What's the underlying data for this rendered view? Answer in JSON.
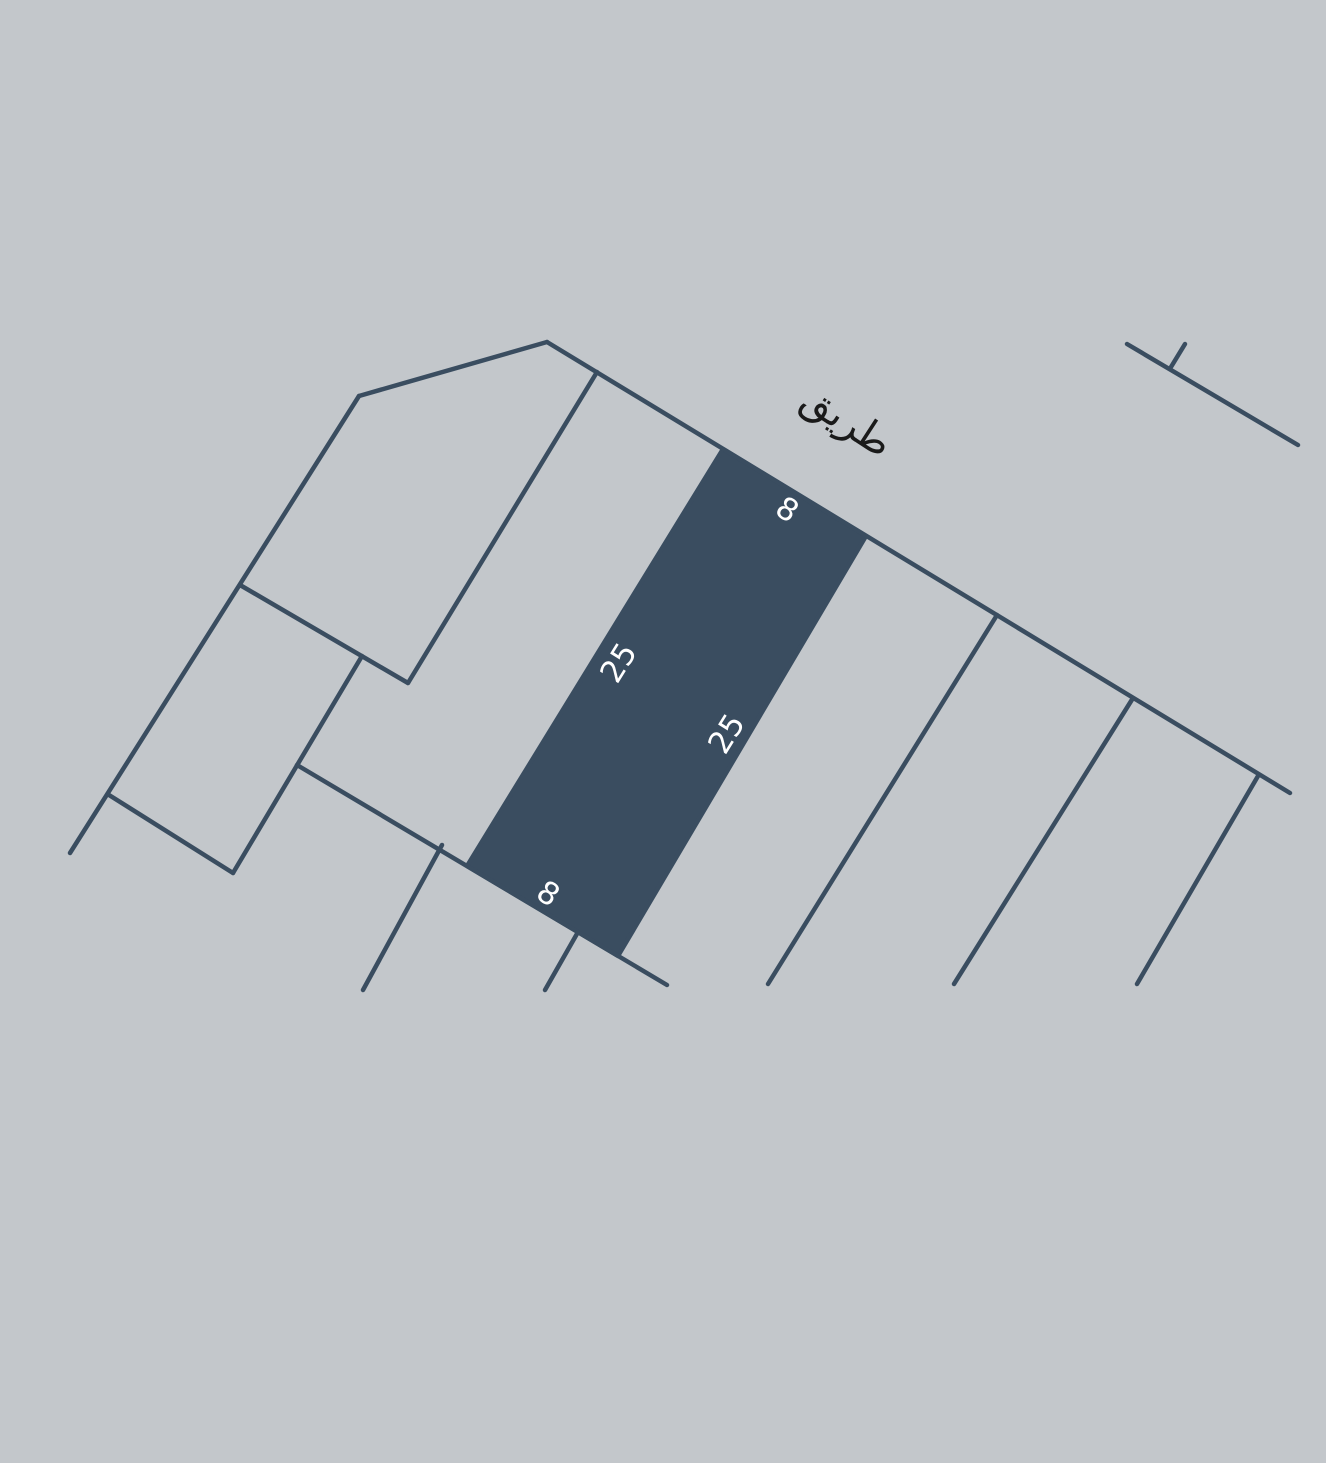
{
  "map": {
    "background_color": "#c3c7cb",
    "line_color": "#3a4d60",
    "line_width": 4.5,
    "road_label": {
      "text": "طريق",
      "x": 847,
      "y": 421,
      "rotation": 33,
      "color": "#1a1a1a",
      "font_size": 40
    },
    "highlighted_plot": {
      "fill": "#3a4d60",
      "points": [
        [
          723,
          449
        ],
        [
          866,
          536
        ],
        [
          618,
          956
        ],
        [
          467,
          866
        ]
      ]
    },
    "dimension_labels": [
      {
        "text": "8",
        "x": 787,
        "y": 510,
        "rotation": 33,
        "color": "#ffffff",
        "font_size": 31
      },
      {
        "text": "25",
        "x": 619,
        "y": 663,
        "rotation": -58,
        "color": "#ffffff",
        "font_size": 31
      },
      {
        "text": "25",
        "x": 727,
        "y": 734,
        "rotation": -58,
        "color": "#ffffff",
        "font_size": 31
      },
      {
        "text": "8",
        "x": 548,
        "y": 894,
        "rotation": 33,
        "color": "#ffffff",
        "font_size": 31
      }
    ],
    "boundary_segments": [
      {
        "name": "road-edge-top",
        "x1": 547,
        "y1": 342,
        "x2": 1290,
        "y2": 793
      },
      {
        "name": "pentagon-top-edge",
        "x1": 359,
        "y1": 396,
        "x2": 547,
        "y2": 342
      },
      {
        "name": "west-boundary",
        "x1": 359,
        "y1": 396,
        "x2": 70,
        "y2": 853
      },
      {
        "name": "divider-pentagon-east",
        "x1": 597,
        "y1": 372,
        "x2": 408,
        "y2": 683
      },
      {
        "name": "pentagon-south-edge",
        "x1": 240,
        "y1": 585,
        "x2": 408,
        "y2": 683
      },
      {
        "name": "southwest-plot-east-edge",
        "x1": 362,
        "y1": 656,
        "x2": 233,
        "y2": 873
      },
      {
        "name": "southwest-plot-south-edge",
        "x1": 109,
        "y1": 795,
        "x2": 233,
        "y2": 873
      },
      {
        "name": "road-edge-bottom",
        "x1": 297,
        "y1": 765,
        "x2": 667,
        "y2": 985
      },
      {
        "name": "tick-south-1",
        "x1": 442,
        "y1": 845,
        "x2": 363,
        "y2": 990
      },
      {
        "name": "tick-south-2",
        "x1": 578,
        "y1": 932,
        "x2": 545,
        "y2": 990
      },
      {
        "name": "divider-east-1",
        "x1": 997,
        "y1": 615,
        "x2": 768,
        "y2": 984
      },
      {
        "name": "divider-east-2",
        "x1": 1133,
        "y1": 698,
        "x2": 954,
        "y2": 984
      },
      {
        "name": "divider-east-3",
        "x1": 1258,
        "y1": 776,
        "x2": 1137,
        "y2": 984
      },
      {
        "name": "northeast-road-line",
        "x1": 1127,
        "y1": 344,
        "x2": 1298,
        "y2": 445
      },
      {
        "name": "northeast-tick",
        "x1": 1185,
        "y1": 344,
        "x2": 1171,
        "y2": 367
      }
    ]
  }
}
